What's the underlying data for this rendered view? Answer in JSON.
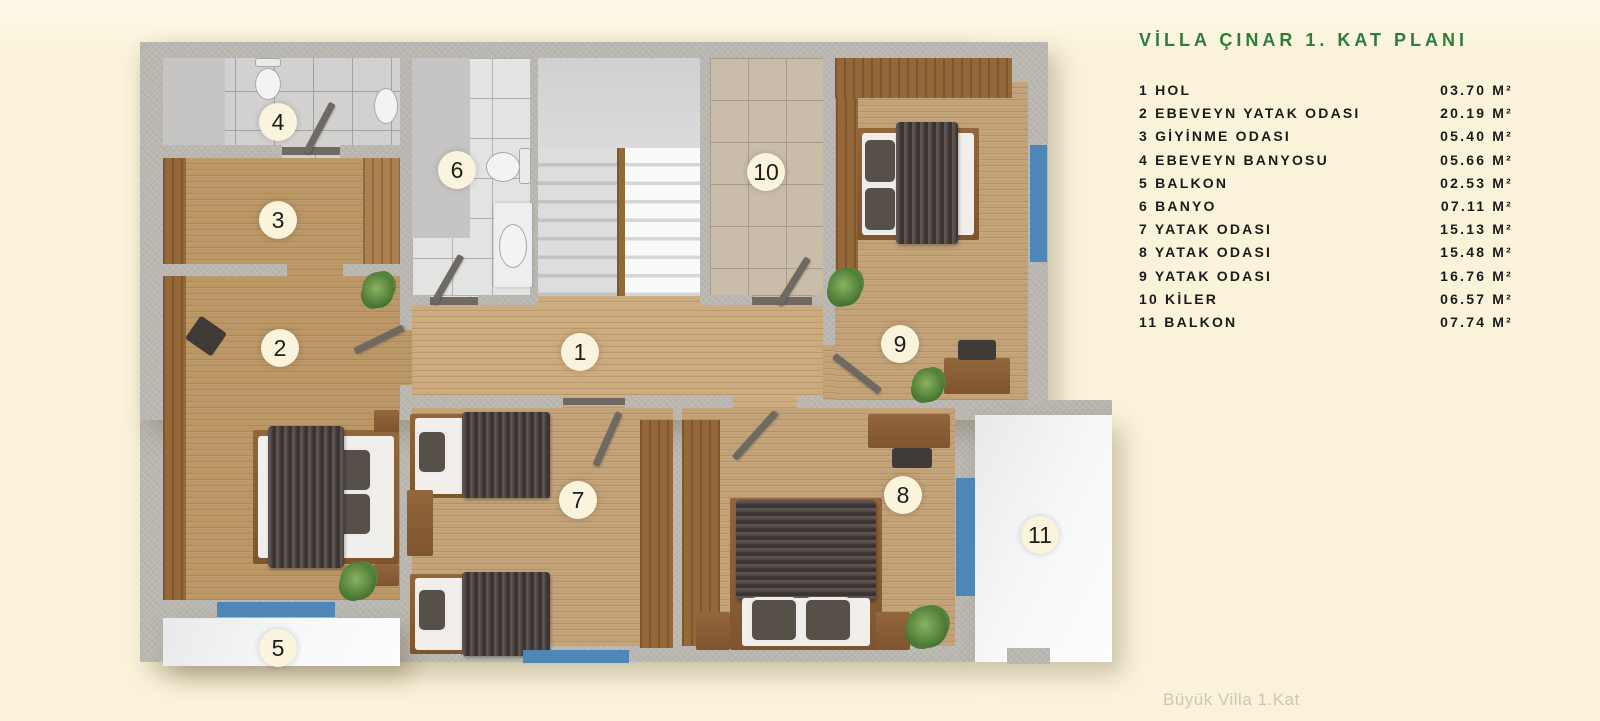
{
  "title": {
    "text": "VİLLA ÇINAR 1. KAT PLANI"
  },
  "legend": {
    "items": [
      {
        "num": "1",
        "name": "HOL",
        "area": "03.70 M²"
      },
      {
        "num": "2",
        "name": "EBEVEYN YATAK ODASI",
        "area": "20.19 M²"
      },
      {
        "num": "3",
        "name": "GİYİNME ODASI",
        "area": "05.40 M²"
      },
      {
        "num": "4",
        "name": "EBEVEYN BANYOSU",
        "area": "05.66 M²"
      },
      {
        "num": "5",
        "name": "BALKON",
        "area": "02.53 M²"
      },
      {
        "num": "6",
        "name": "BANYO",
        "area": "07.11 M²"
      },
      {
        "num": "7",
        "name": "YATAK ODASI",
        "area": "15.13 M²"
      },
      {
        "num": "8",
        "name": "YATAK ODASI",
        "area": "15.48 M²"
      },
      {
        "num": "9",
        "name": "YATAK ODASI",
        "area": "16.76 M²"
      },
      {
        "num": "10",
        "name": "KİLER",
        "area": "06.57 M²"
      },
      {
        "num": "11",
        "name": "BALKON",
        "area": "07.74 M²"
      }
    ]
  },
  "footer": {
    "text": "Büyük Villa 1.Kat"
  },
  "plan": {
    "badges": [
      {
        "num": "1",
        "x": 580,
        "y": 352
      },
      {
        "num": "2",
        "x": 280,
        "y": 348
      },
      {
        "num": "3",
        "x": 278,
        "y": 220
      },
      {
        "num": "4",
        "x": 278,
        "y": 122
      },
      {
        "num": "5",
        "x": 278,
        "y": 648
      },
      {
        "num": "6",
        "x": 457,
        "y": 170
      },
      {
        "num": "7",
        "x": 578,
        "y": 500
      },
      {
        "num": "8",
        "x": 903,
        "y": 495
      },
      {
        "num": "9",
        "x": 900,
        "y": 344
      },
      {
        "num": "10",
        "x": 766,
        "y": 172
      },
      {
        "num": "11",
        "x": 1040,
        "y": 535
      }
    ]
  },
  "colors": {
    "background": "#FAF3DA",
    "title_green": "#2E7D3B",
    "wall_gray": "#B9B7B0",
    "window_blue": "#4E86B5",
    "wood_floor": "#C3A277",
    "legend_text": "#1B1B19",
    "caption_gray": "#CBC6B9"
  }
}
